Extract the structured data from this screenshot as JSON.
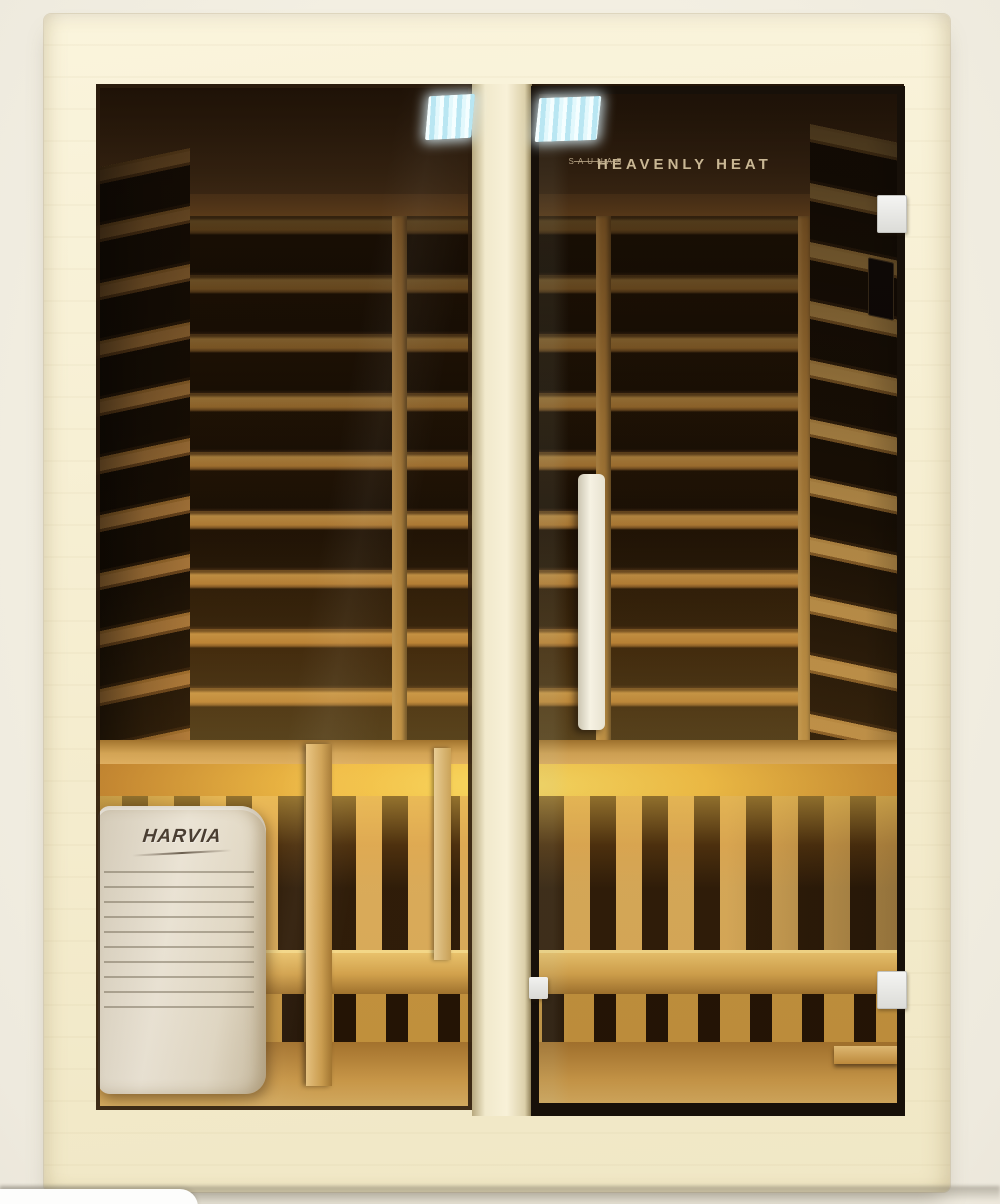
{
  "image": {
    "type": "product-photo",
    "subject": "infrared sauna cabin with glass door, interior carbon heating panels, bench and heater",
    "background_color": "#f2eee1"
  },
  "branding": {
    "door_logo_title": "HEAVENLY HEAT",
    "door_logo_subtitle": "SAUNAS",
    "heater_brand": "HARVIA"
  },
  "colors": {
    "frame_wood": "#f5eed3",
    "interior_rail_wood": "#b57f36",
    "heating_panel_dark": "#1c1105",
    "under_bench_glow": "#ffd94e",
    "ceiling_led": "#bfe9f4",
    "door_trim": "#171009",
    "handle": "#f6f2e3",
    "hinge": "#e9e9e7",
    "heater_body": "#ece5d5",
    "logo_text": "#c9b794"
  }
}
